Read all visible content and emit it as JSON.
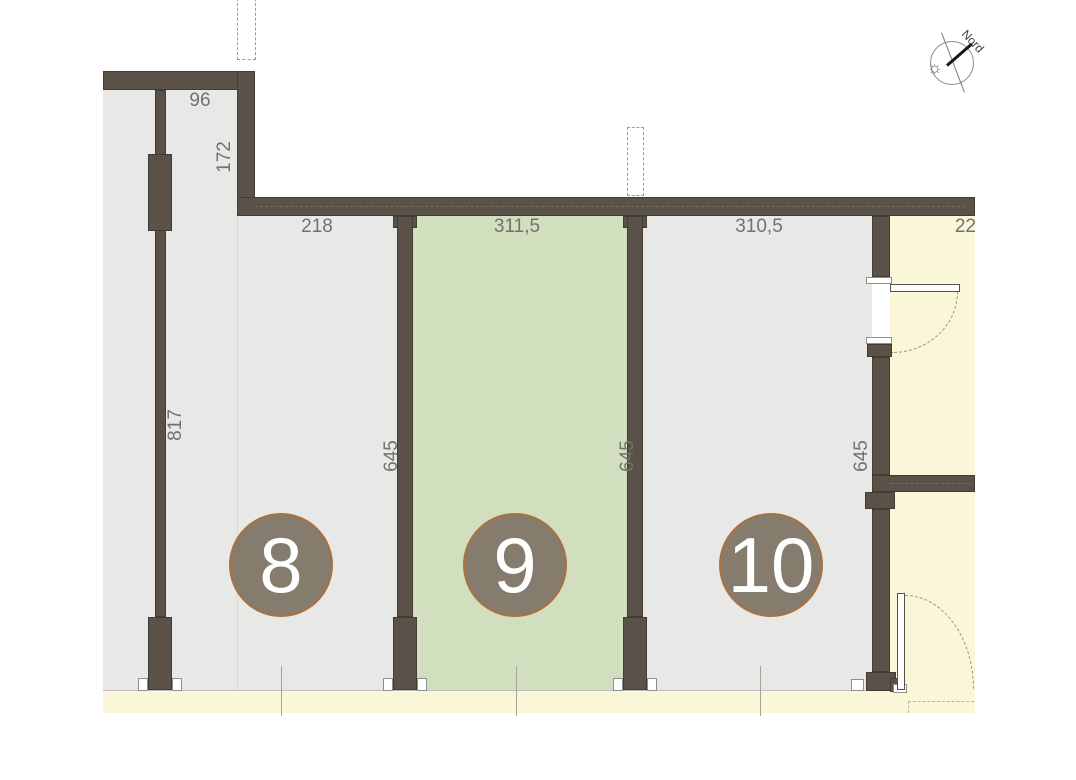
{
  "plan": {
    "type": "floor-plan",
    "north_label": "Nord",
    "badges": {
      "u8": "8",
      "u9": "9",
      "u10": "10"
    },
    "labels": {
      "w96": "96",
      "h172": "172",
      "w218": "218",
      "w311": "311,5",
      "w310": "310,5",
      "w22": "22",
      "h817": "817",
      "h645a": "645",
      "h645b": "645",
      "h645c": "645"
    },
    "units": [
      {
        "number": "8",
        "top_width": "218",
        "side_depth": "817",
        "highlighted": false
      },
      {
        "number": "9",
        "top_width": "311,5",
        "side_depth": "645",
        "highlighted": true
      },
      {
        "number": "10",
        "top_width": "310,5",
        "side_depth": "645",
        "highlighted": false
      }
    ],
    "colors": {
      "wall": "#5a5248",
      "floor": "#e8e8e6",
      "highlight_unit": "#d2dfbe",
      "corridor": "#faf6d8",
      "badge_fill": "#857c6e",
      "badge_border": "#aa713e",
      "dimension_text": "#717171"
    }
  }
}
